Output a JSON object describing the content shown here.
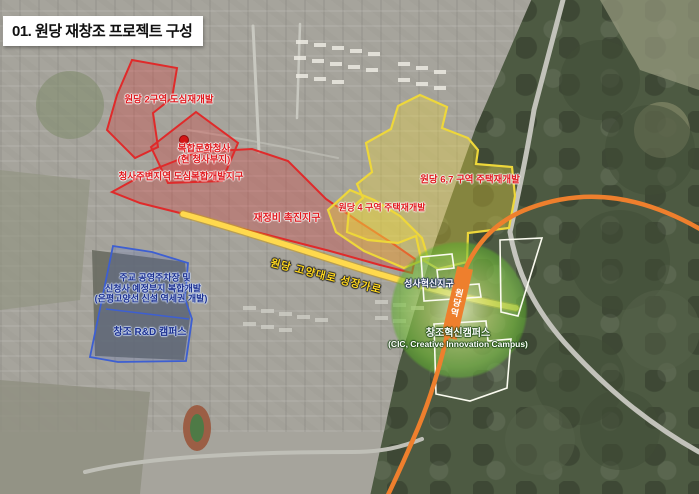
{
  "title": "01. 원당 재창조 프로젝트 구성",
  "colors": {
    "red_zone": "#e02a2a",
    "yellow_zone": "#eed73a",
    "blue_zone": "#3d5fd2",
    "white_zone": "#fbfbf0",
    "green_circle": "#6ab832",
    "orange_line": "#ee7f2d",
    "road_yellow": "#ffd94d",
    "label_red": "#e0191e",
    "label_navy": "#1b2f8f",
    "label_road_yellow": "#ffd81f"
  },
  "zones": {
    "wondang2": {
      "label": "원당 2구역 도심재개발"
    },
    "city_hall": {
      "label_line1": "복합문화청사",
      "label_line2": "(현 청사부지)"
    },
    "around_city_hall": {
      "label": "청사주변지역 도심복합개발지구"
    },
    "promotion": {
      "label": "재정비 촉진지구"
    },
    "wondang67": {
      "label": "원당 6,7 구역 주택재개발"
    },
    "wondang4": {
      "label": "원당 4 구역 주택재개발"
    },
    "jugyo": {
      "label_line1": "주교 공영주차장 및",
      "label_line2": "신청사 예정부지 복합개발",
      "label_line3": "(은평고양선 신설 역세권 개발)"
    },
    "rnd_campus": {
      "label": "창조 R&D 캠퍼스"
    },
    "seongsa": {
      "label": "성사혁신지구"
    },
    "cic": {
      "label_line1": "창조혁신캠퍼스",
      "label_line2": "(CIC, Creative Innovation Campus)"
    }
  },
  "road_label": "원당 고양대로 성장가로",
  "station_label": "원당역"
}
